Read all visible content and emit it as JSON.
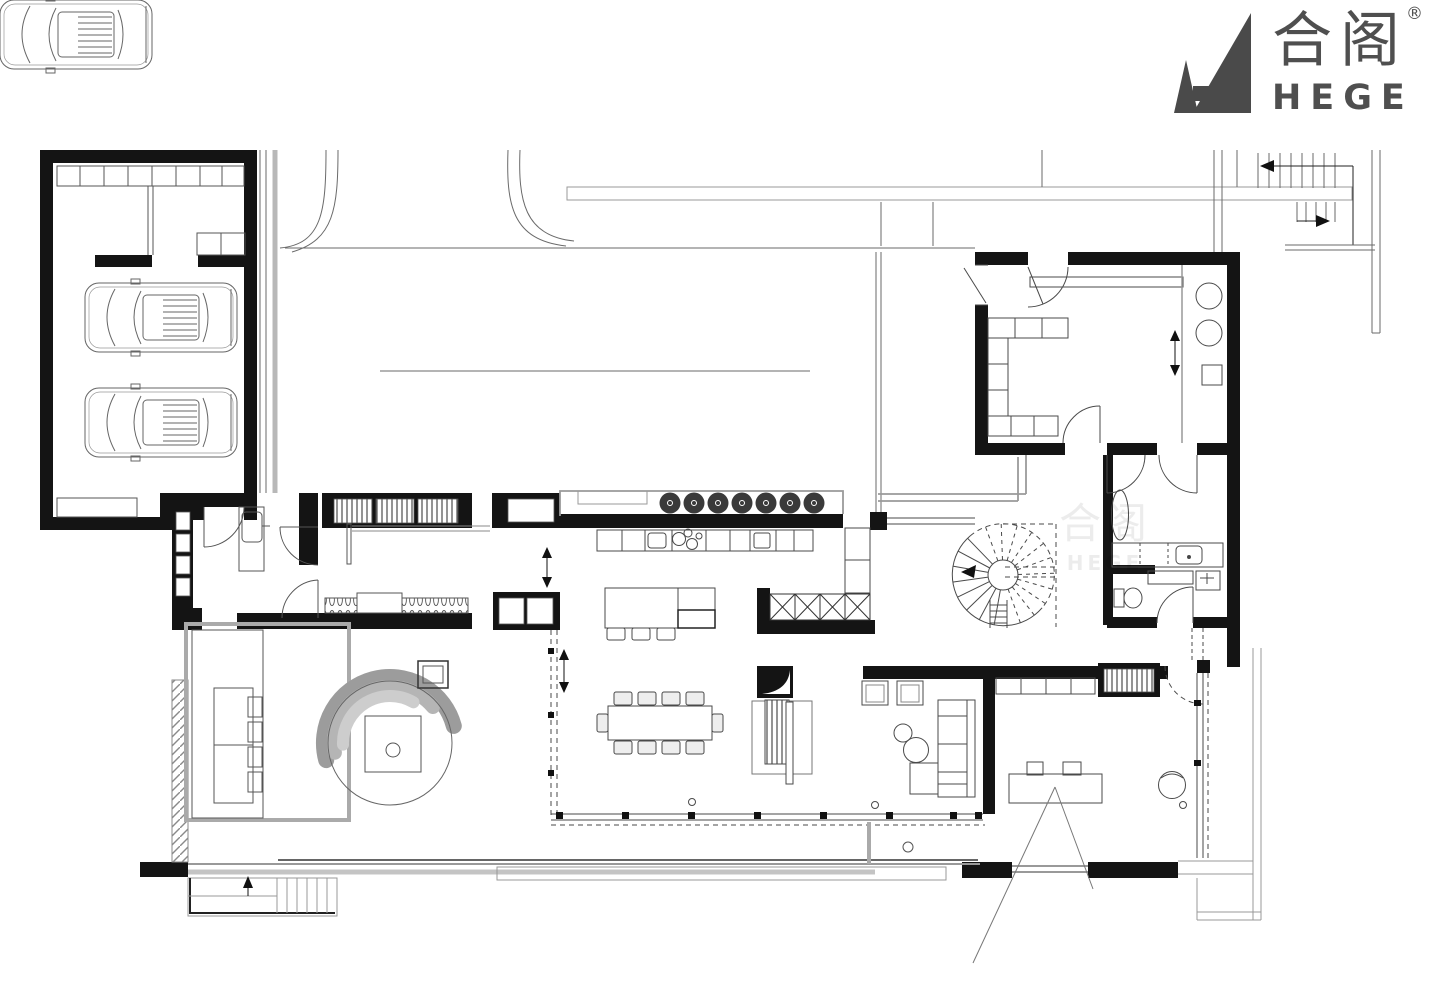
{
  "brand": {
    "logo_cn": "合阁",
    "logo_en": "HEGE",
    "registered": "®",
    "logo_color": "#4a4a4a"
  },
  "watermark": {
    "line1": "合阁",
    "line2": "HEGE"
  },
  "colors": {
    "background": "#ffffff",
    "wall": "#141414",
    "line": "#4a4a4a",
    "line_light": "#8a8a8a",
    "line_pale": "#c4c4c4",
    "stool_fill": "#3a3a3a",
    "canopy_dark": "#9c9c9c",
    "canopy_mid": "#b5b5b5",
    "canopy_light": "#cdcdcd"
  }
}
